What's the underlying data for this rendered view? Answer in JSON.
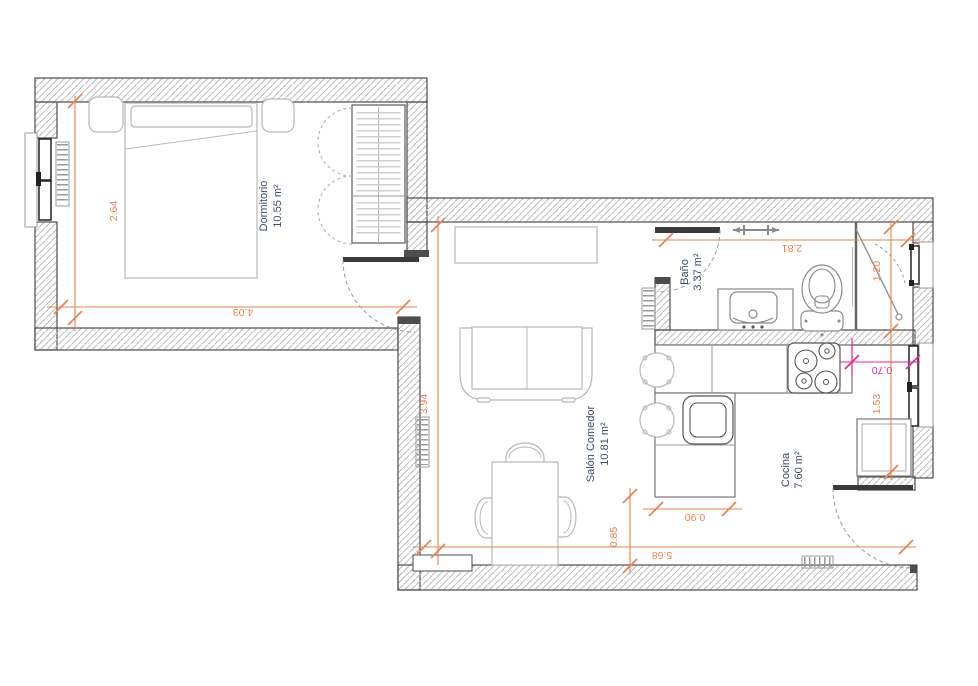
{
  "rooms": [
    {
      "name": "Dormitorio",
      "area": "10.55 m²"
    },
    {
      "name": "Salón Comedor",
      "area": "10.81 m²"
    },
    {
      "name": "Baño",
      "area": "3.37 m²"
    },
    {
      "name": "Cocina",
      "area": "7.60 m²"
    }
  ],
  "dims": {
    "bedroom_depth": "2.64",
    "bedroom_width": "4.03",
    "salon_depth": "3.94",
    "bath_width": "2.81",
    "shower_width": "1.20",
    "kitchen_side": "1.53",
    "hob_clearance": "0.70",
    "peninsula_width": "0.90",
    "table_clearance": "0.85",
    "bottom_width": "5.68"
  },
  "colors": {
    "dimension": "#E8834F",
    "highlight": "#EC268F",
    "room_label": "#3D4D68",
    "wall_outline": "#4d4d4d"
  }
}
